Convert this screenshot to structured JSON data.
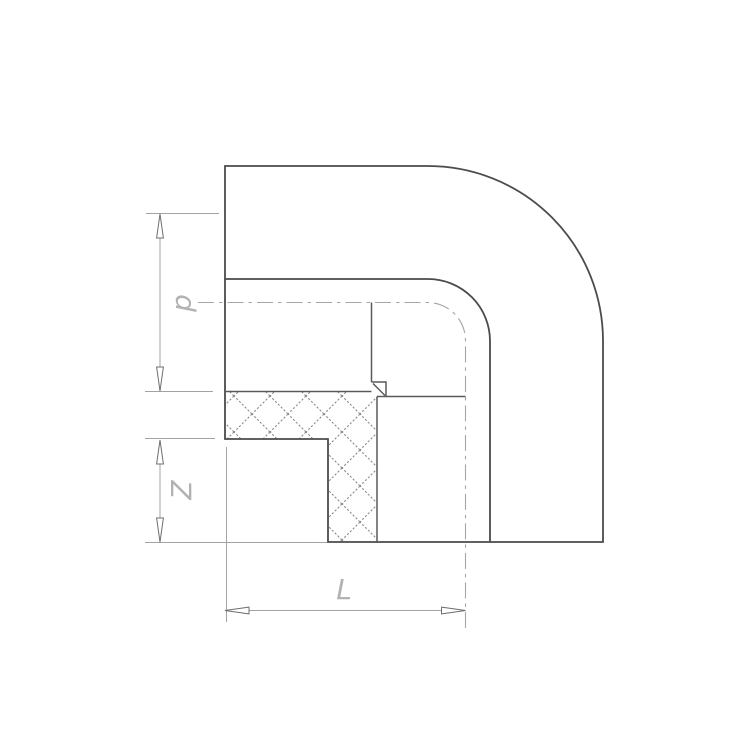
{
  "drawing": {
    "title": "90-degree elbow pipe fitting, half-section technical drawing",
    "background_color": "#ffffff",
    "colors": {
      "outline": "#4b4b4b",
      "section_detail": "#5a5a5a",
      "hatch": "#8c8c8c",
      "centerline": "#a6a6a6",
      "dimension_line": "#a3a3a3",
      "arrow_outline": "#6f6f6f",
      "arrow_fill": "#ffffff",
      "label": "#b2b2b2"
    },
    "dimension_labels": {
      "p": "p",
      "z": "Z",
      "l": "L"
    },
    "dimensions": [
      {
        "label": "p",
        "orientation": "vertical"
      },
      {
        "label": "Z",
        "orientation": "vertical"
      },
      {
        "label": "L",
        "orientation": "horizontal"
      }
    ]
  }
}
